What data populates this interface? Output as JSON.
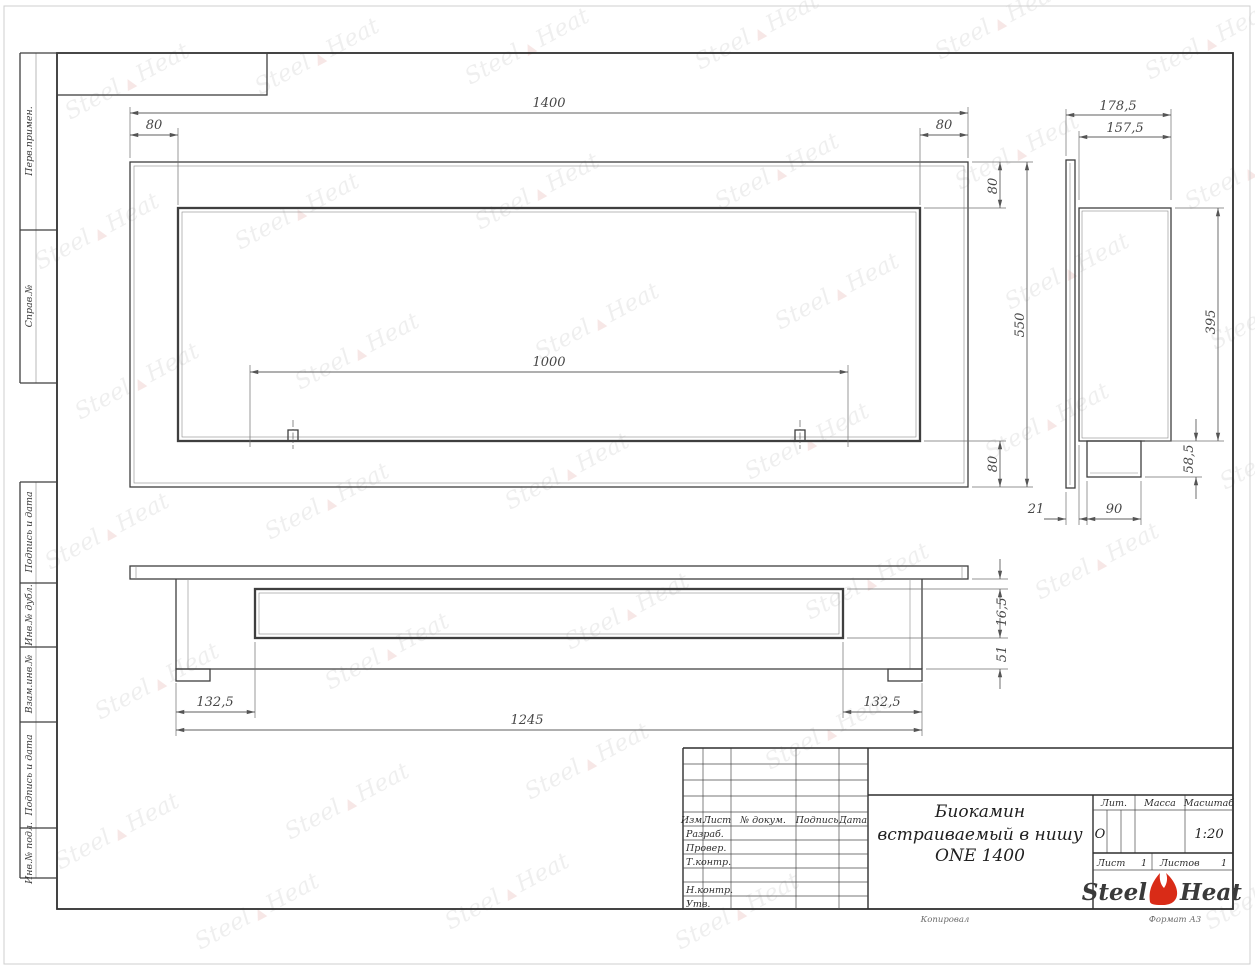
{
  "frame": {
    "margin_labels": [
      "Перв.примен.",
      "Справ.№",
      "Подпись и дата",
      "Инв.№ дубл.",
      "Взам.инв.№",
      "Подпись и дата",
      "Инв.№ подл."
    ],
    "footer": {
      "kopiroval": "Копировал",
      "format": "Формат А3"
    }
  },
  "views": {
    "front": {
      "dims": {
        "width": "1400",
        "inset_left": "80",
        "inset_right": "80",
        "inset_top": "80",
        "height": "550",
        "burner": "1000",
        "inset_bottom": "80"
      }
    },
    "side": {
      "dims": {
        "depth_total": "178,5",
        "depth_box": "157,5",
        "height": "395",
        "tray_height": "58,5",
        "front_gap": "21",
        "tray_depth": "90"
      }
    },
    "bottom": {
      "dims": {
        "lip": "16,5",
        "tray": "51",
        "margin_left": "132,5",
        "length": "1245",
        "margin_right": "132,5"
      }
    }
  },
  "title_block": {
    "revision_header": {
      "izm": "Изм.",
      "list": "Лист",
      "doc": "№ докум.",
      "sign": "Подпись",
      "date": "Дата"
    },
    "roles": {
      "razrab": "Разраб.",
      "prover": "Провер.",
      "tkontr": "Т.контр.",
      "nkontr": "Н.контр.",
      "utv": "Утв."
    },
    "title": {
      "line1": "Биокамин",
      "line2": "встраиваемый в нишу",
      "line3": "ONE 1400"
    },
    "props": {
      "lit_label": "Лит.",
      "lit_value": "О",
      "mass_label": "Масса",
      "scale_label": "Масштаб",
      "scale_value": "1:20"
    },
    "sheets": {
      "list_label": "Лист",
      "list_value": "1",
      "listov_label": "Листов",
      "listov_value": "1"
    },
    "brand": {
      "steel": "Steel",
      "heat": "Heat"
    }
  },
  "watermark": {
    "steel": "Steel",
    "flame": "▲",
    "heat": "Heat"
  },
  "colors": {
    "accent_red": "#d92b17",
    "line": "#3f3f3f",
    "dim": "#5f5f5f"
  }
}
